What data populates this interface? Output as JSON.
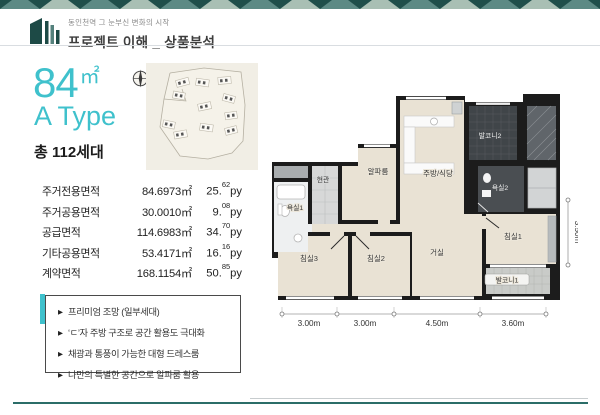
{
  "header": {
    "tagline": "동인천역 그 눈부신 변화의 시작",
    "title": "프로젝트 이해 _ 상품분석"
  },
  "unit": {
    "area_value": "84",
    "area_unit": "㎡",
    "type_name": "A Type",
    "households": "총 112세대"
  },
  "area_table": {
    "py_unit": "py",
    "rows": [
      {
        "label": "주거전용면적",
        "sqm": "84.6973㎡",
        "py_main": "25.",
        "py_sup": "62"
      },
      {
        "label": "주거공용면적",
        "sqm": "30.0010㎡",
        "py_main": "9.",
        "py_sup": "08"
      },
      {
        "label": "공급면적",
        "sqm": "114.6983㎡",
        "py_main": "34.",
        "py_sup": "70"
      },
      {
        "label": "기타공용면적",
        "sqm": "53.4171㎡",
        "py_main": "16.",
        "py_sup": "16"
      },
      {
        "label": "계약면적",
        "sqm": "168.1154㎡",
        "py_main": "50.",
        "py_sup": "85"
      }
    ]
  },
  "features": {
    "bullet": "▶",
    "items": [
      "프리미엄 조망 (일부세대)",
      "‘ㄷ’자 주방 구조로 공간 활용도 극대화",
      "채광과 통풍이 가능한 대형 드레스룸",
      "나만의 특별한 공간으로 알파룸 활용"
    ]
  },
  "floor_plan": {
    "rooms": [
      {
        "id": "entrance",
        "label": "현관"
      },
      {
        "id": "bathroom-1",
        "label": "욕실1"
      },
      {
        "id": "bedroom-3",
        "label": "침실3"
      },
      {
        "id": "bedroom-2",
        "label": "침실2"
      },
      {
        "id": "alpha-room",
        "label": "알파룸"
      },
      {
        "id": "kitchen-dining",
        "label": "주방/식당"
      },
      {
        "id": "balcony-2",
        "label": "발코니2"
      },
      {
        "id": "bathroom-2",
        "label": "욕실2"
      },
      {
        "id": "living-room",
        "label": "거실"
      },
      {
        "id": "bedroom-1",
        "label": "침실1"
      },
      {
        "id": "balcony-1",
        "label": "발코니1"
      }
    ],
    "dims_bottom": [
      "3.00m",
      "3.00m",
      "4.50m",
      "3.60m"
    ],
    "dim_right": "3.50m"
  },
  "colors": {
    "accent": "#3fc1cc",
    "band_dark": "#1f4e4a",
    "band_mid": "#5d8a85",
    "band_light": "#a9bfb4",
    "footer_line": "#2b6d68"
  }
}
